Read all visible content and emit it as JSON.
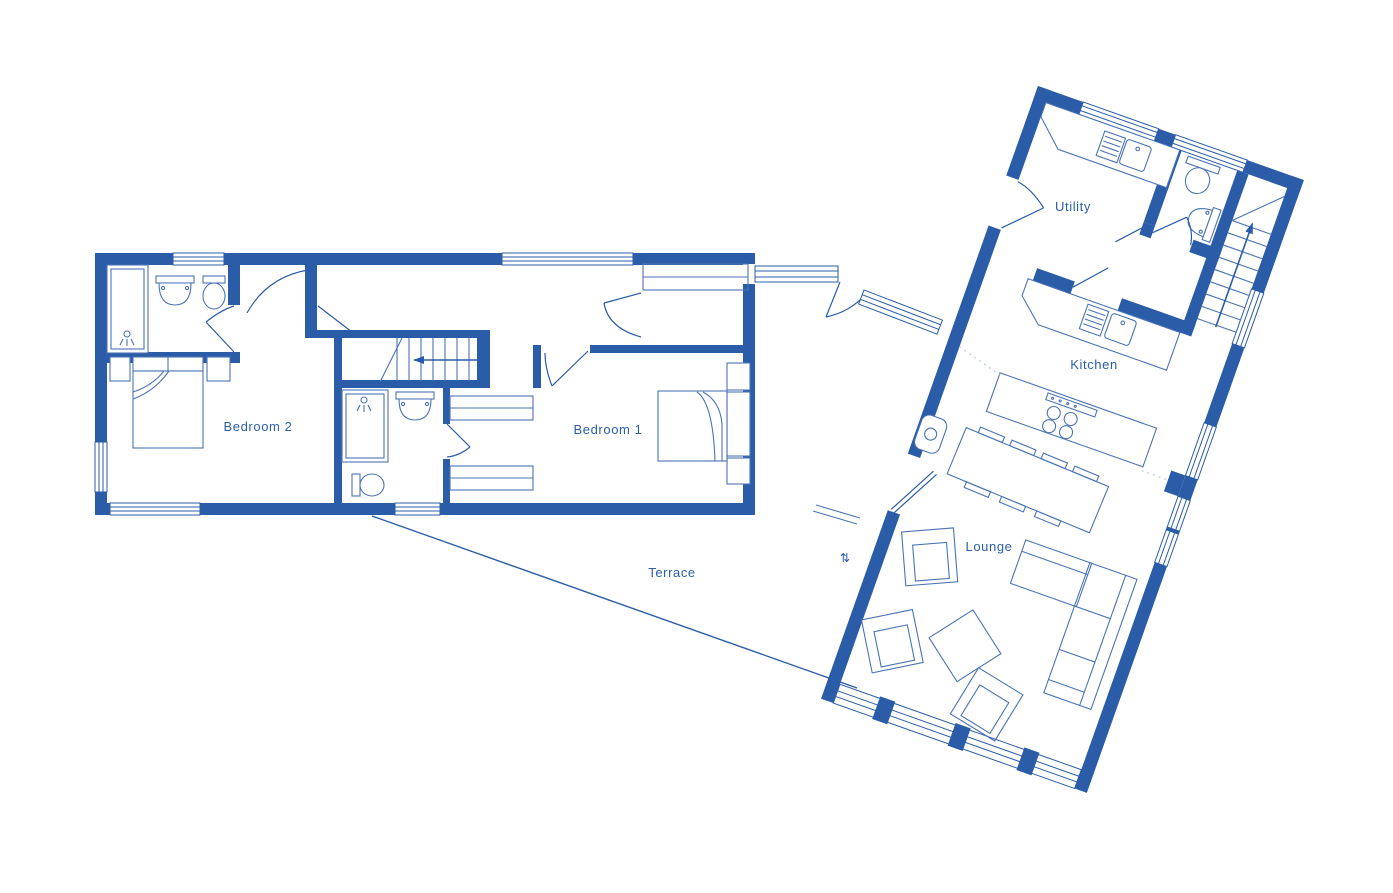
{
  "title": "Ground floor plan",
  "colors": {
    "wall": "#2b5ca7",
    "furniture": "#4b74b4",
    "text": "#2b5fac",
    "background": "#ffffff",
    "dotted": "#c5d2e8"
  },
  "rooms": [
    {
      "id": "bedroom-2",
      "label": "Bedroom 2"
    },
    {
      "id": "bedroom-1",
      "label": "Bedroom 1"
    },
    {
      "id": "terrace",
      "label": "Terrace"
    },
    {
      "id": "utility",
      "label": "Utility"
    },
    {
      "id": "kitchen",
      "label": "Kitchen"
    },
    {
      "id": "lounge",
      "label": "Lounge"
    }
  ],
  "icons": {
    "stairs_up_arrow": "up-arrow",
    "stairs_left_arrow": "left-arrow",
    "door_swing_symbol": "⇅"
  }
}
